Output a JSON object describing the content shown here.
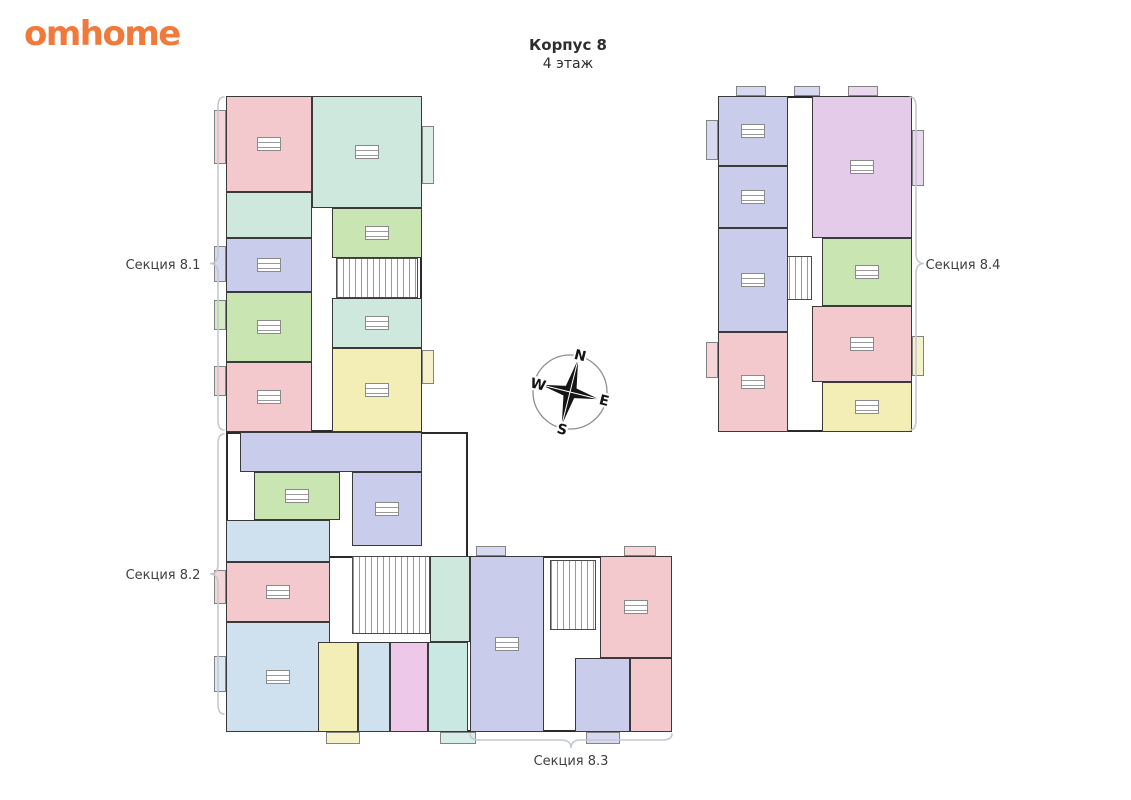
{
  "logo": {
    "text": "omhome",
    "color": "#f0793c"
  },
  "title": {
    "line1": "Корпус 8",
    "line2": "4 этаж"
  },
  "sections": [
    {
      "id": "8.1",
      "label": "Секция 8.1"
    },
    {
      "id": "8.2",
      "label": "Секция 8.2"
    },
    {
      "id": "8.3",
      "label": "Секция 8.3"
    },
    {
      "id": "8.4",
      "label": "Секция 8.4"
    }
  ],
  "compass": {
    "n": "N",
    "w": "W",
    "e": "E",
    "s": "S",
    "rotation_deg": 14
  },
  "palette": {
    "wall": "#3a3a3a",
    "brace": "#c3c9d0",
    "pink": "#f3c9cd",
    "mint": "#cfe8dd",
    "green": "#c9e6b2",
    "lavender": "#c9cdeb",
    "blue": "#cfe0ee",
    "yellow": "#f3edb6",
    "magenta": "#eec8e8",
    "teal": "#c9e8e1",
    "orchid": "#e4cbe9"
  },
  "plan": {
    "panels": [
      {
        "x": 226,
        "y": 96,
        "w": 196,
        "h": 336
      },
      {
        "x": 226,
        "y": 432,
        "w": 242,
        "h": 300
      },
      {
        "x": 318,
        "y": 556,
        "w": 354,
        "h": 176
      },
      {
        "x": 718,
        "y": 96,
        "w": 194,
        "h": 336
      }
    ],
    "units": [
      {
        "x": 226,
        "y": 96,
        "w": 86,
        "h": 96,
        "c": "pink"
      },
      {
        "x": 226,
        "y": 192,
        "w": 86,
        "h": 46,
        "c": "mint"
      },
      {
        "x": 226,
        "y": 238,
        "w": 86,
        "h": 54,
        "c": "lavender"
      },
      {
        "x": 226,
        "y": 292,
        "w": 86,
        "h": 70,
        "c": "green"
      },
      {
        "x": 226,
        "y": 362,
        "w": 86,
        "h": 70,
        "c": "pink"
      },
      {
        "x": 312,
        "y": 96,
        "w": 110,
        "h": 112,
        "c": "mint"
      },
      {
        "x": 332,
        "y": 208,
        "w": 90,
        "h": 50,
        "c": "green"
      },
      {
        "x": 332,
        "y": 298,
        "w": 90,
        "h": 50,
        "c": "mint"
      },
      {
        "x": 332,
        "y": 348,
        "w": 90,
        "h": 84,
        "c": "yellow"
      },
      {
        "x": 240,
        "y": 432,
        "w": 182,
        "h": 40,
        "c": "lavender"
      },
      {
        "x": 254,
        "y": 472,
        "w": 86,
        "h": 48,
        "c": "green"
      },
      {
        "x": 352,
        "y": 472,
        "w": 70,
        "h": 74,
        "c": "lavender"
      },
      {
        "x": 226,
        "y": 520,
        "w": 104,
        "h": 42,
        "c": "blue"
      },
      {
        "x": 226,
        "y": 562,
        "w": 104,
        "h": 60,
        "c": "pink"
      },
      {
        "x": 226,
        "y": 622,
        "w": 104,
        "h": 110,
        "c": "blue"
      },
      {
        "x": 318,
        "y": 642,
        "w": 40,
        "h": 90,
        "c": "yellow"
      },
      {
        "x": 358,
        "y": 642,
        "w": 32,
        "h": 90,
        "c": "blue"
      },
      {
        "x": 390,
        "y": 642,
        "w": 38,
        "h": 90,
        "c": "magenta"
      },
      {
        "x": 428,
        "y": 642,
        "w": 40,
        "h": 90,
        "c": "teal"
      },
      {
        "x": 430,
        "y": 556,
        "w": 40,
        "h": 86,
        "c": "mint"
      },
      {
        "x": 470,
        "y": 556,
        "w": 74,
        "h": 176,
        "c": "lavender"
      },
      {
        "x": 575,
        "y": 658,
        "w": 55,
        "h": 74,
        "c": "lavender"
      },
      {
        "x": 600,
        "y": 556,
        "w": 72,
        "h": 102,
        "c": "pink"
      },
      {
        "x": 630,
        "y": 658,
        "w": 42,
        "h": 74,
        "c": "pink"
      },
      {
        "x": 718,
        "y": 96,
        "w": 70,
        "h": 70,
        "c": "lavender"
      },
      {
        "x": 718,
        "y": 166,
        "w": 70,
        "h": 62,
        "c": "lavender"
      },
      {
        "x": 718,
        "y": 228,
        "w": 70,
        "h": 104,
        "c": "lavender"
      },
      {
        "x": 718,
        "y": 332,
        "w": 70,
        "h": 100,
        "c": "pink"
      },
      {
        "x": 812,
        "y": 96,
        "w": 100,
        "h": 142,
        "c": "orchid"
      },
      {
        "x": 822,
        "y": 238,
        "w": 90,
        "h": 68,
        "c": "green"
      },
      {
        "x": 812,
        "y": 306,
        "w": 100,
        "h": 76,
        "c": "pink"
      },
      {
        "x": 822,
        "y": 382,
        "w": 90,
        "h": 50,
        "c": "yellow"
      }
    ],
    "balconies": [
      {
        "x": 214,
        "y": 110,
        "w": 12,
        "h": 54,
        "c": "pink"
      },
      {
        "x": 214,
        "y": 246,
        "w": 12,
        "h": 36,
        "c": "lavender"
      },
      {
        "x": 214,
        "y": 300,
        "w": 12,
        "h": 30,
        "c": "green"
      },
      {
        "x": 214,
        "y": 366,
        "w": 12,
        "h": 30,
        "c": "pink"
      },
      {
        "x": 422,
        "y": 126,
        "w": 12,
        "h": 58,
        "c": "mint"
      },
      {
        "x": 422,
        "y": 350,
        "w": 12,
        "h": 34,
        "c": "yellow"
      },
      {
        "x": 214,
        "y": 570,
        "w": 12,
        "h": 34,
        "c": "pink"
      },
      {
        "x": 214,
        "y": 656,
        "w": 12,
        "h": 36,
        "c": "blue"
      },
      {
        "x": 326,
        "y": 732,
        "w": 34,
        "h": 12,
        "c": "yellow"
      },
      {
        "x": 440,
        "y": 732,
        "w": 36,
        "h": 12,
        "c": "teal"
      },
      {
        "x": 586,
        "y": 732,
        "w": 34,
        "h": 12,
        "c": "lavender"
      },
      {
        "x": 476,
        "y": 546,
        "w": 30,
        "h": 10,
        "c": "lavender"
      },
      {
        "x": 624,
        "y": 546,
        "w": 32,
        "h": 10,
        "c": "pink"
      },
      {
        "x": 706,
        "y": 120,
        "w": 12,
        "h": 40,
        "c": "lavender"
      },
      {
        "x": 706,
        "y": 342,
        "w": 12,
        "h": 36,
        "c": "pink"
      },
      {
        "x": 912,
        "y": 130,
        "w": 12,
        "h": 56,
        "c": "orchid"
      },
      {
        "x": 912,
        "y": 336,
        "w": 12,
        "h": 40,
        "c": "yellow"
      },
      {
        "x": 736,
        "y": 86,
        "w": 30,
        "h": 10,
        "c": "lavender"
      },
      {
        "x": 794,
        "y": 86,
        "w": 26,
        "h": 10,
        "c": "lavender"
      },
      {
        "x": 848,
        "y": 86,
        "w": 30,
        "h": 10,
        "c": "orchid"
      }
    ],
    "stairs": [
      {
        "x": 336,
        "y": 258,
        "w": 82,
        "h": 40
      },
      {
        "x": 352,
        "y": 556,
        "w": 78,
        "h": 78
      },
      {
        "x": 550,
        "y": 560,
        "w": 46,
        "h": 70
      },
      {
        "x": 740,
        "y": 256,
        "w": 72,
        "h": 44
      }
    ],
    "braces": [
      {
        "type": "v",
        "x": 218,
        "y1": 97,
        "y2": 430,
        "dir": -1,
        "section": 0
      },
      {
        "type": "v",
        "x": 218,
        "y1": 434,
        "y2": 714,
        "dir": -1,
        "section": 1
      },
      {
        "type": "h",
        "y": 740,
        "x1": 470,
        "x2": 672,
        "section": 2
      },
      {
        "type": "v",
        "x": 916,
        "y1": 97,
        "y2": 430,
        "dir": 1,
        "section": 3
      }
    ]
  }
}
